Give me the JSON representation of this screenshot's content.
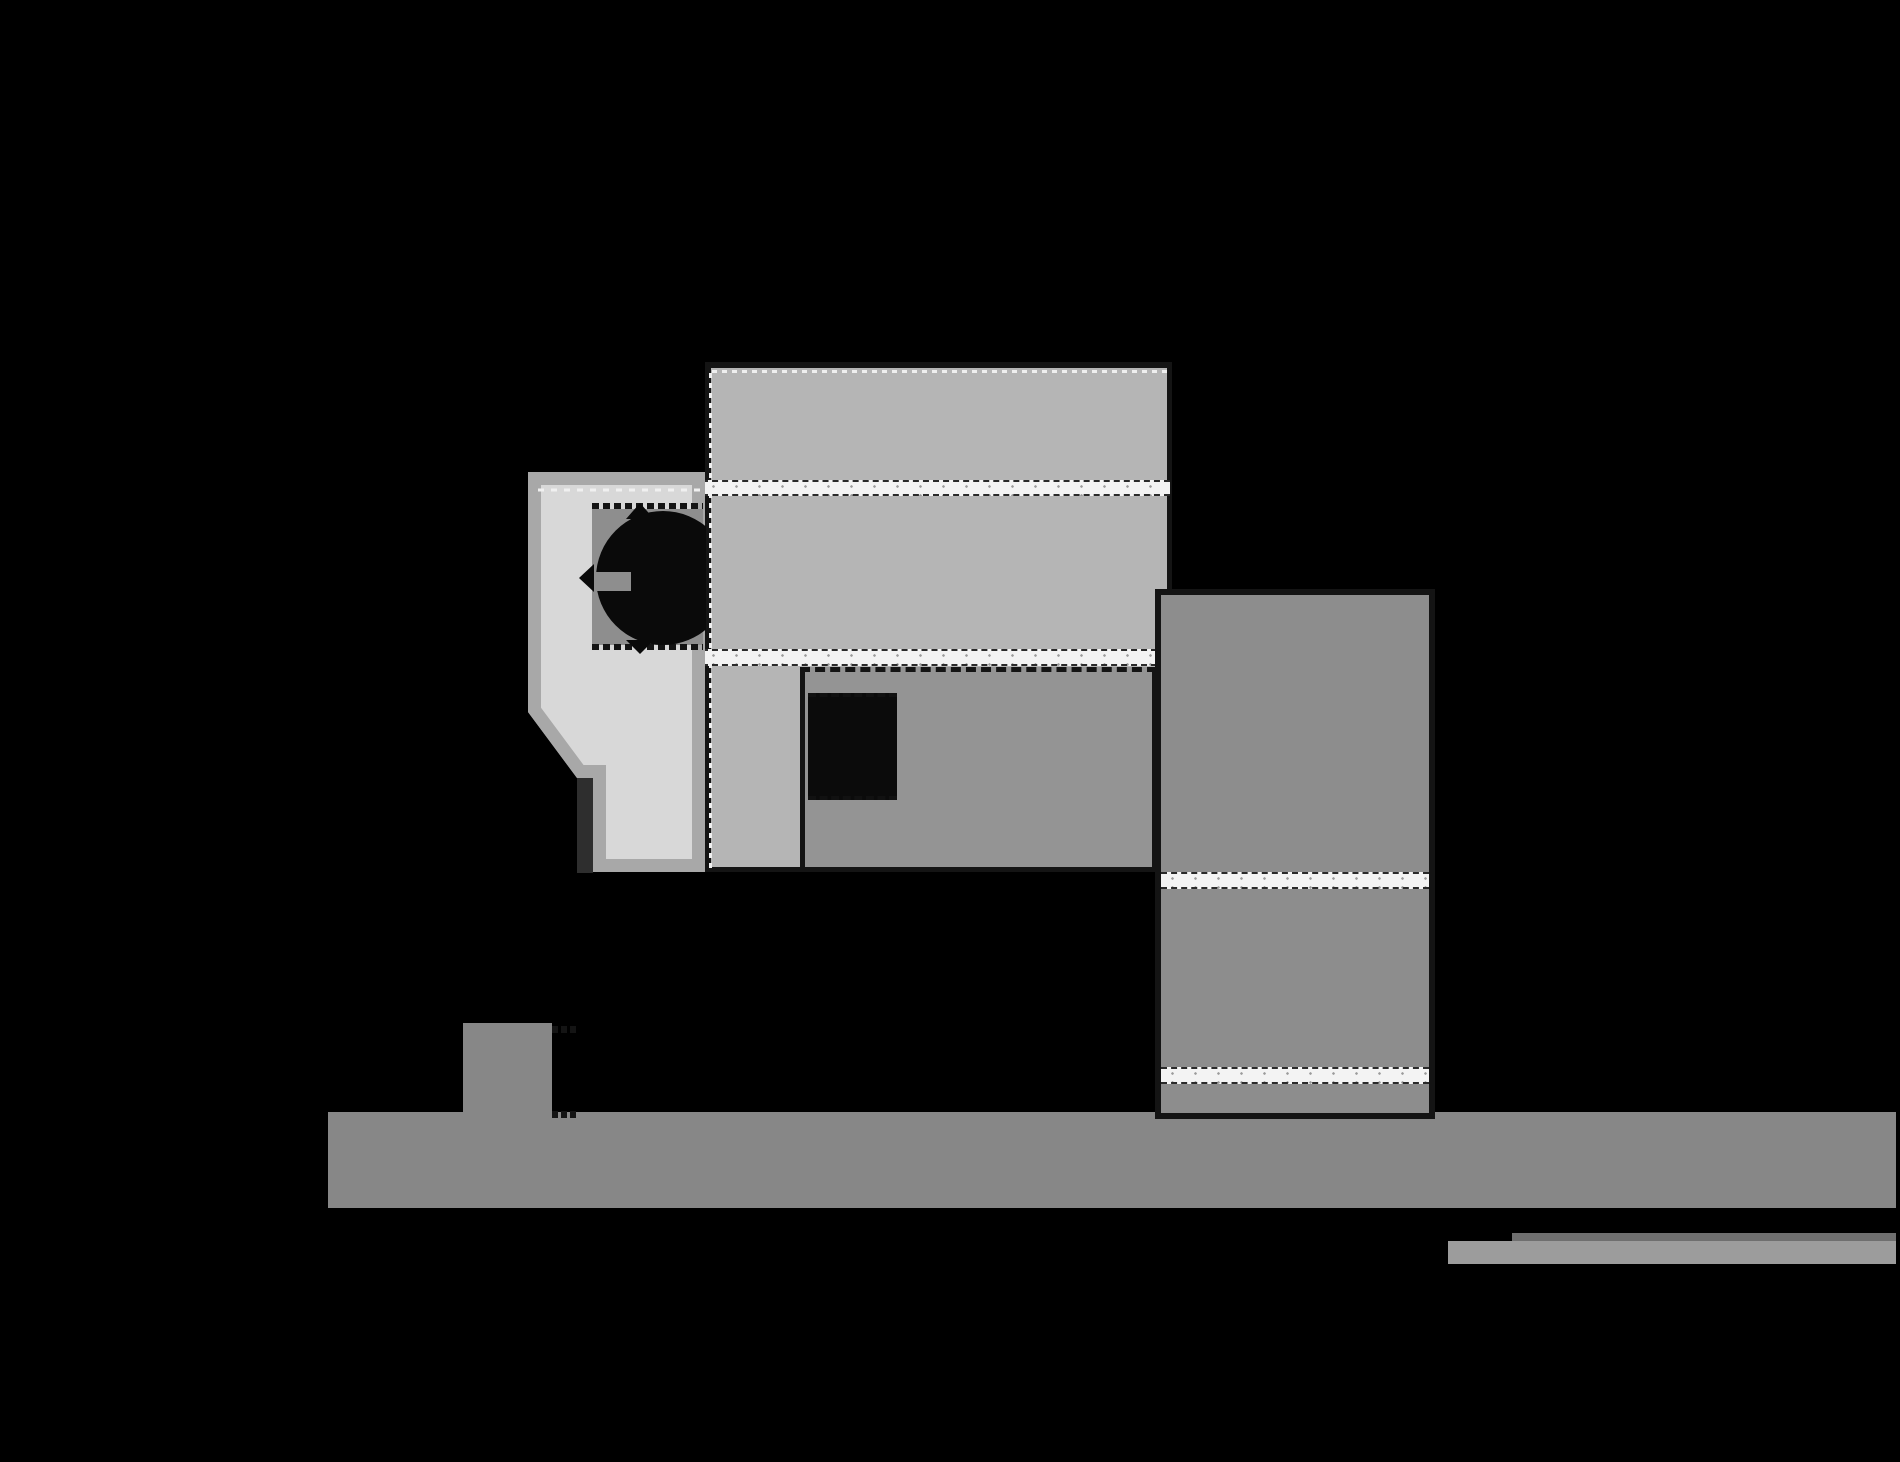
{
  "scene": {
    "kind": "architectural-elevation-drawing",
    "background": "black",
    "text_content": "none"
  },
  "palette": {
    "bg": "#000000",
    "block_top": "#b5b5b5",
    "house_fill": "#d8d8d8",
    "house_band": "#a8a8a8",
    "recess": "#8e8e8e",
    "tree": "#0a0a0a",
    "block_mid": "#949494",
    "window_dark": "#0b0b0b",
    "tower": "#8d8d8d",
    "stripe_white": "#f3f3f3",
    "speckle": "#9a9a9a",
    "ground": "#878787",
    "dark_bar": "#2e2e2e",
    "bar_light": "#9c9c9c",
    "bar_dark": "#6f6f6f",
    "edge_dark": "#141414"
  },
  "shapes": [
    {
      "name": "ground-strip",
      "color": "#878787",
      "note": "horizontal ground band, lower area"
    },
    {
      "name": "chimney-block",
      "color": "#878787",
      "note": "small block standing on ground, left"
    },
    {
      "name": "rear-banded-block",
      "color": "#b5b5b5",
      "note": "large light block with two white bands"
    },
    {
      "name": "render-band-upper",
      "color": "#f3f3f3"
    },
    {
      "name": "render-band-lower",
      "color": "#f3f3f3"
    },
    {
      "name": "house-block",
      "color": "#d8d8d8",
      "note": "lightest block with chamfered lower-left corner"
    },
    {
      "name": "house-recess",
      "color": "#8e8e8e",
      "note": "recessed opening containing tree symbol"
    },
    {
      "name": "tree-symbol",
      "color": "#0a0a0a",
      "note": "black circular tree canopy with pointed arcs"
    },
    {
      "name": "house-dark-post",
      "color": "#2e2e2e"
    },
    {
      "name": "middle-block",
      "color": "#949494",
      "note": "block with single black window"
    },
    {
      "name": "middle-window",
      "color": "#0b0b0b"
    },
    {
      "name": "tower-block",
      "color": "#8d8d8d",
      "note": "tall right block with two white bands"
    },
    {
      "name": "tower-band-upper",
      "color": "#f3f3f3"
    },
    {
      "name": "tower-band-lower",
      "color": "#f3f3f3"
    },
    {
      "name": "wall-bar-dark",
      "color": "#6f6f6f"
    },
    {
      "name": "wall-bar-light",
      "color": "#9c9c9c"
    }
  ]
}
